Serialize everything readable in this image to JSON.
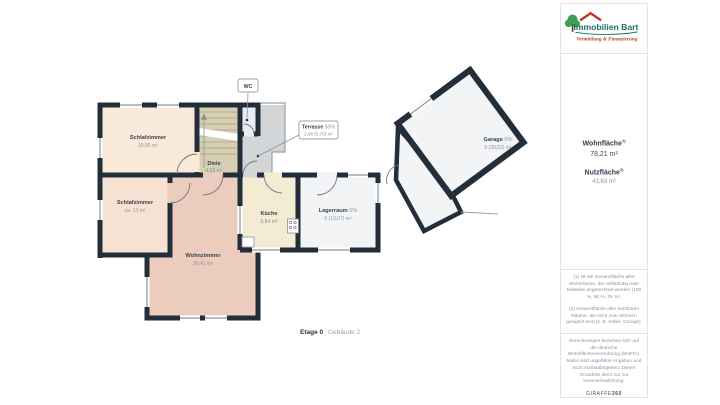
{
  "branding": {
    "logo_text": "Immobilien Bart",
    "logo_tagline": "Vermittlung & Finanzierung",
    "logo_teal": "#1d6e62",
    "logo_red": "#c0392b"
  },
  "sidebar": {
    "wohnflaeche_label": "Wohnfläche",
    "wohnflaeche_sup": "1)",
    "wohnflaeche_value": "78,21 m²",
    "nutzflaeche_label": "Nutzfläche",
    "nutzflaeche_sup": "2)",
    "nutzflaeche_value": "43,63 m²",
    "footnote1": "(1) Ist die Gesamtfläche aller Wohnräume, die vollständig oder teilweise angerechnet werden (100 %, 50 %, 25 %).",
    "footnote2": "(2) Gesamtfläche aller nutzbaren Räume, die nicht zum Wohnen geeignet sind (z. B. Keller, Garage).",
    "disclaimer": "Berechnungen beziehen sich auf die deutsche Wohnflächenverordnung (WoFlV). Maße sind ungefähre Angaben und nicht maßstabsgetreu. Dieser Grundriss dient nur zur Veranschaulichung.",
    "vendor": "GIRAFFE",
    "vendor_bold": "360"
  },
  "plan": {
    "floor_label": "Etage 0",
    "building_label": "Gebäude 2",
    "rooms": {
      "schlafzimmer1": {
        "name": "Schlafzimmer",
        "area": "15,95 m²"
      },
      "schlafzimmer2": {
        "name": "Schlafzimmer",
        "area": "ca. 13 m²"
      },
      "wohnzimmer": {
        "name": "Wohnzimmer",
        "area": "30,41 m²"
      },
      "kueche": {
        "name": "Küche",
        "area": "9,84 m²"
      },
      "diele": {
        "name": "Diele",
        "area": "4,03 m²"
      },
      "lagerraum": {
        "name": "Lagerraum",
        "pct": "0%",
        "area": "0 (13,07) m²"
      },
      "wc": {
        "name": "WC"
      },
      "terrasse": {
        "name": "Terrasse",
        "pct": "50%",
        "area": "2,88 (5,76) m²"
      },
      "garage": {
        "name": "Garage",
        "pct": "0%",
        "area": "0 (30,62) m²"
      }
    },
    "colors": {
      "wall": "#232e3b",
      "schlafzimmer1": "#f8e9d8",
      "schlafzimmer2": "#f6e2d3",
      "wohnzimmer": "#ecccbd",
      "kueche": "#f3ebd2",
      "diele": "#d7cfb1",
      "wc": "#e9edf3",
      "terrasse": "#d4d5d7",
      "lagerraum": "#f3f4f6",
      "garage": "#f3f4f6"
    }
  }
}
